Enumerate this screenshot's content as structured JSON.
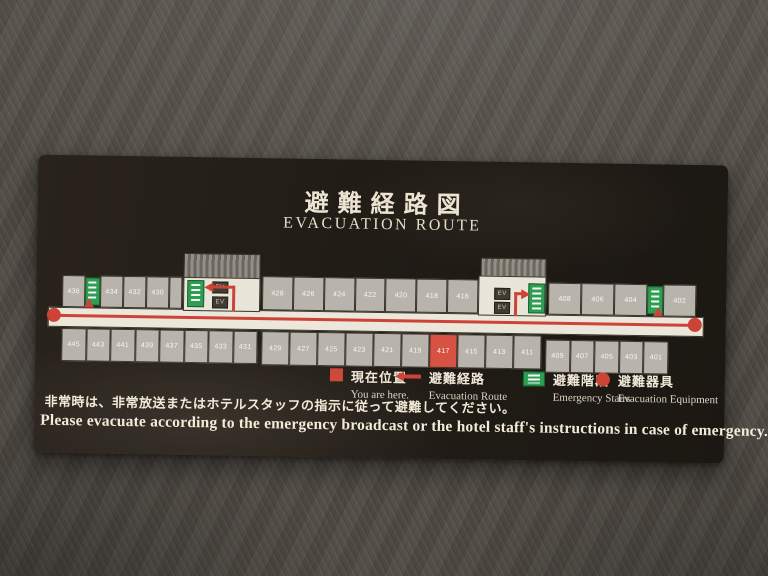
{
  "sign": {
    "title_ja": "避難経路図",
    "title_en": "EVACUATION ROUTE",
    "notice_ja": "非常時は、非常放送またはホテルスタッフの指示に従って避難してください。",
    "notice_en": "Please evacuate according to the emergency broadcast or the hotel staff's instructions in case of emergency."
  },
  "legend": [
    {
      "icon": "current-position-square",
      "ja": "現在位置",
      "en": "You are here."
    },
    {
      "icon": "route-arrow",
      "ja": "避難経路",
      "en": "Evacuation Route"
    },
    {
      "icon": "emergency-stairs",
      "ja": "避難階段",
      "en": "Emergency Stairs"
    },
    {
      "icon": "equipment-circle",
      "ja": "避難器具",
      "en": "Evacuation Equipment"
    }
  ],
  "floorplan": {
    "red_room": "417",
    "elevator_label": "EV",
    "top_left": [
      "436",
      "STAIRS",
      "434",
      "432",
      "430",
      "BLANK"
    ],
    "top_mid": [
      "428",
      "426",
      "424",
      "422",
      "420",
      "418",
      "416"
    ],
    "top_right": [
      "408",
      "406",
      "404",
      "STAIRS",
      "402"
    ],
    "bottom_left": [
      "445",
      "443",
      "441",
      "439",
      "437",
      "435",
      "433",
      "431"
    ],
    "bottom_mid": [
      "429",
      "427",
      "425",
      "423",
      "421",
      "419",
      "417",
      "415",
      "413",
      "411"
    ],
    "bottom_right": [
      "409",
      "407",
      "405",
      "403",
      "401"
    ]
  },
  "colors": {
    "accent_red": "#cd4337",
    "stair_green": "#2f9e53",
    "panel_dark": "#211c16",
    "room_gray": "#b8b4ac",
    "corridor_cream": "#ebe7da"
  }
}
